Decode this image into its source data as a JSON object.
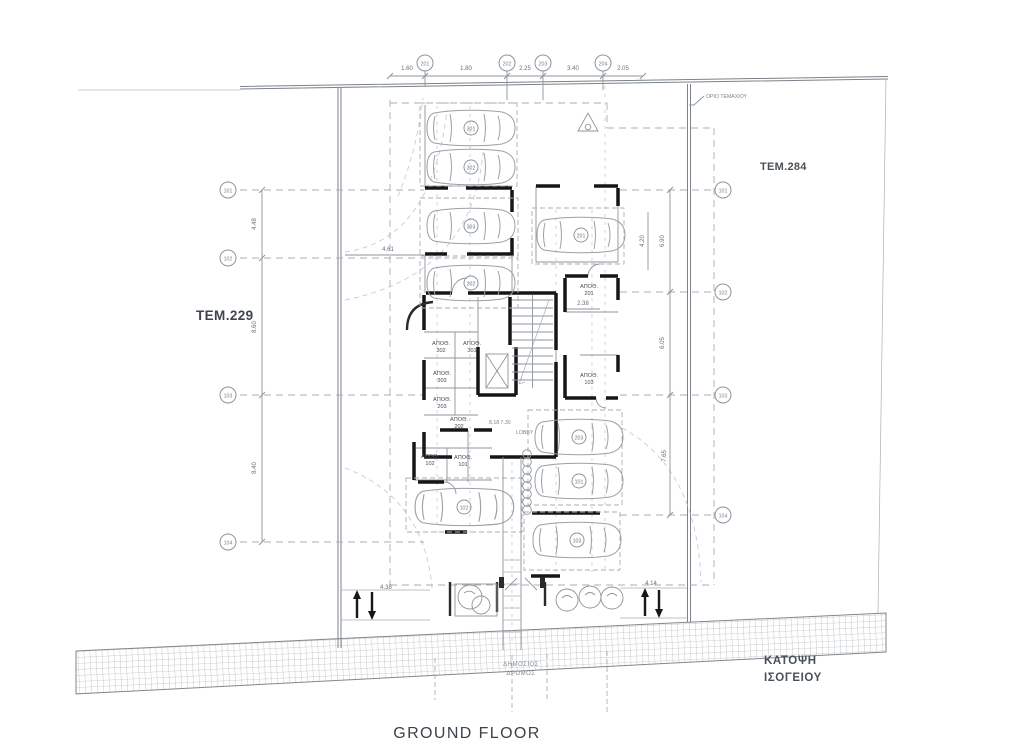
{
  "titles": {
    "drawing_title": "GROUND FLOOR",
    "caption_line1": "ΚΑΤΟΨΗ",
    "caption_line2": "ΙΣΟΓΕΙΟΥ"
  },
  "plots": {
    "left_label": "ΤΕΜ.229",
    "right_label": "ΤΕΜ.284"
  },
  "road": {
    "label_line1": "ΔΗΜΟΣΙΟΣ",
    "label_line2": "ΔΡΟΜΟΣ"
  },
  "notes": {
    "boundary": "ΟΡΙΟ ΤΕΜΑΧΙΟΥ",
    "lobby": "LOBBY",
    "lobby_levels": "8.18  7.30"
  },
  "grid": {
    "top_bubbles": [
      "201",
      "202",
      "203",
      "204"
    ],
    "top_dims": [
      "1.60",
      "1.80",
      "2.25",
      "3.40",
      "2.05"
    ],
    "left_bubbles": [
      "101",
      "102",
      "103",
      "104"
    ],
    "left_dims": [
      "4.48",
      "8.60",
      "8.40"
    ],
    "right_bubbles": [
      "101",
      "102",
      "103",
      "104"
    ],
    "right_dims": [
      "6.90",
      "6.05",
      "7.65"
    ],
    "inner_dims": {
      "upper": "4.61",
      "right_inner": "4.20",
      "storage": "2.38",
      "ramp_left": "4.38",
      "ramp_right": "4.14"
    }
  },
  "storage_rooms": [
    {
      "label": "ΑΠΟΘ.",
      "number": "302"
    },
    {
      "label": "ΑΠΟΘ.",
      "number": "301"
    },
    {
      "label": "ΑΠΟΘ.",
      "number": "303"
    },
    {
      "label": "ΑΠΟΘ.",
      "number": "203"
    },
    {
      "label": "ΑΠΟΘ.",
      "number": "202"
    },
    {
      "label": "ΑΠΟΘ.",
      "number": "102"
    },
    {
      "label": "ΑΠΟΘ.",
      "number": "101"
    },
    {
      "label": "ΑΠΟΘ.",
      "number": "201"
    },
    {
      "label": "ΑΠΟΘ.",
      "number": "103"
    }
  ],
  "parking": {
    "spots": [
      "301",
      "302",
      "303",
      "201",
      "202",
      "203",
      "101",
      "102",
      "103"
    ]
  },
  "colors": {
    "wall": "#161616",
    "line": "#8e959c",
    "text_dark": "#3d434b"
  }
}
